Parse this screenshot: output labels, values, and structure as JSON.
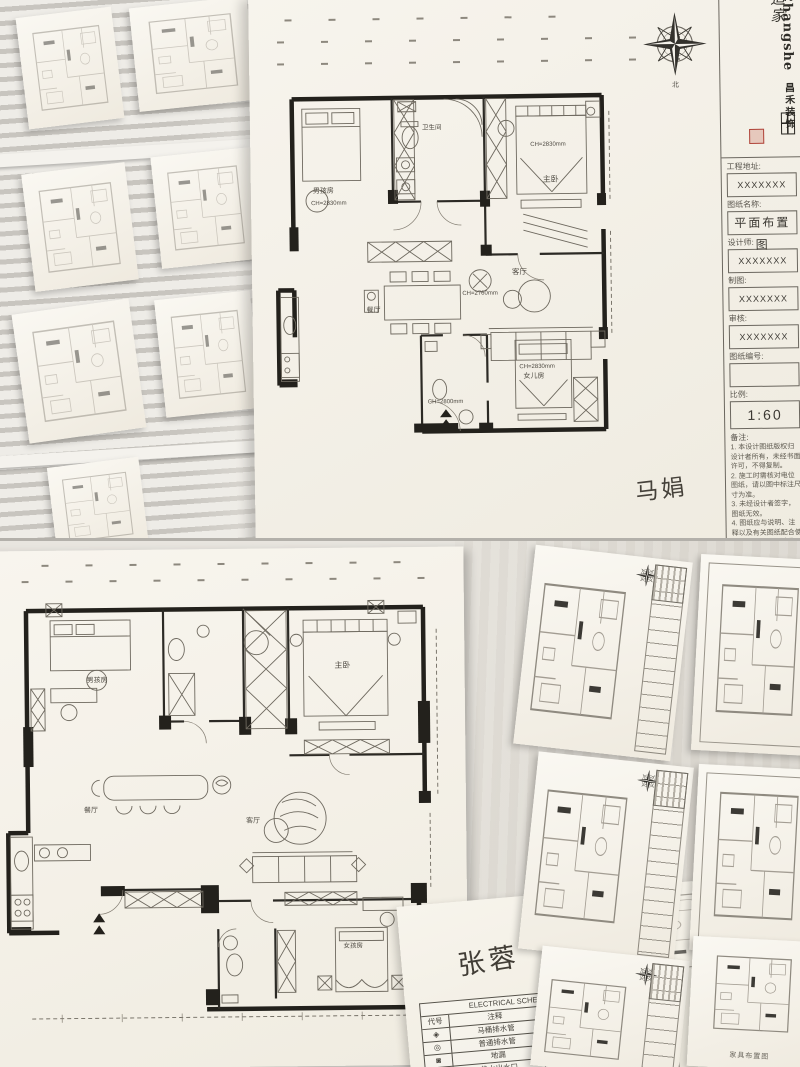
{
  "brand": {
    "logo_text": "Changshe",
    "logo_sub": "昌禾装饰",
    "calligraphy_1": "造家",
    "calligraphy_2": "造梦",
    "calligraphy_3": "造生活"
  },
  "compass": {
    "north": "北"
  },
  "title_block": {
    "fields": [
      {
        "label": "工程地址:",
        "value": "XXXXXXX"
      },
      {
        "label": "图纸名称:",
        "value": "平面布置图"
      },
      {
        "label": "设计师:",
        "value": "XXXXXXX"
      },
      {
        "label": "制图:",
        "value": "XXXXXXX"
      },
      {
        "label": "审核:",
        "value": "XXXXXXX"
      },
      {
        "label": "图纸编号:",
        "value": ""
      },
      {
        "label": "比例:",
        "value": "1:60"
      }
    ],
    "notes_label": "备注:",
    "notes": [
      "1. 本设计图纸版权归设计者所有，未经书面许可，不得复制。",
      "2. 施工时需核对电位图纸，请以图中标注尺寸为准。",
      "3. 未经设计者签字，图纸无效。",
      "4. 图纸应与说明、注释以及有关图纸配合使用，如发现问题请及时通知设计者。"
    ]
  },
  "plan_top": {
    "rooms": {
      "boys": "男孩房",
      "bath": "卫生间",
      "master": "主卧",
      "dining": "餐厅",
      "living": "客厅",
      "girls": "女儿房"
    },
    "dims": {
      "boys": "CH=2830mm",
      "master": "CH=2830mm",
      "dining": "CH=2760mm",
      "bath2": "CH=2800mm",
      "girls": "CH=2830mm"
    },
    "signature": "马娟"
  },
  "plan_bottom": {
    "rooms": {
      "boys": "男孩房",
      "master": "主卧",
      "dining": "餐厅",
      "living": "客厅",
      "girls": "女孩房"
    },
    "signature": "张蓉"
  },
  "schedule": {
    "title": "ELECTRICAL SCHEDULE / 室内装饰制图图例",
    "headers": [
      "代号",
      "注释",
      "代号",
      "注释"
    ],
    "rows": [
      [
        "◈",
        "马桶排水管",
        "■",
        "分水器"
      ],
      [
        "◎",
        "普通排水管",
        "▩",
        "强电箱"
      ],
      [
        "◙",
        "地漏",
        "▩",
        "弱电箱"
      ],
      [
        "●",
        "热水出水口",
        "▭",
        "燃气表"
      ],
      [
        "○",
        "净水出水口",
        "▦",
        "普通插座箱"
      ]
    ]
  },
  "captions": {
    "furniture_plan": "家具布置图"
  }
}
